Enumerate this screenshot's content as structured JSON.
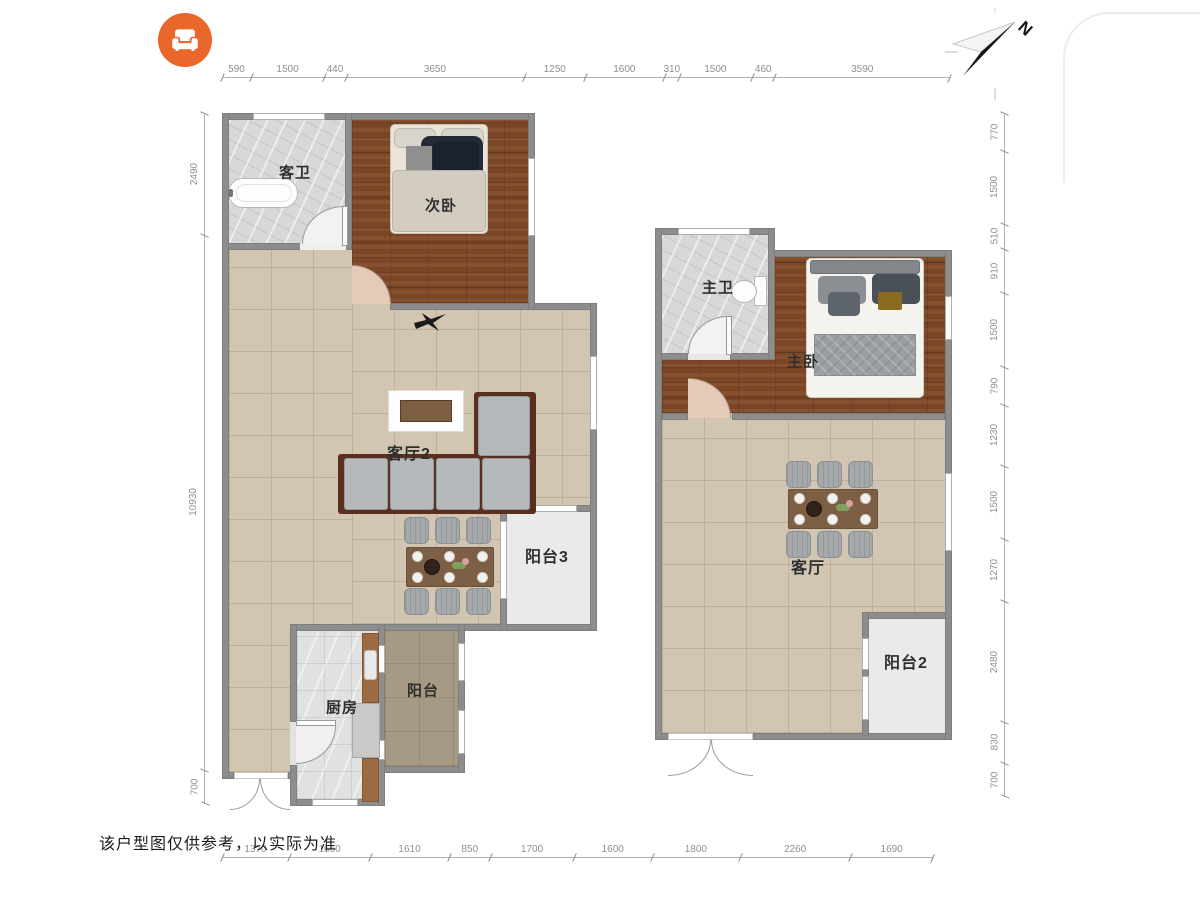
{
  "app": {
    "logo_icon": "sofa-icon"
  },
  "compass": {
    "label": "N"
  },
  "disclaimer": "该户型图仅供参考，以实际为准",
  "units": {
    "left": {
      "rooms": {
        "guest_bath": "客卫",
        "second_bedroom": "次卧",
        "living2": "客厅2",
        "balcony3": "阳台3",
        "kitchen": "厨房",
        "balcony": "阳台"
      }
    },
    "right": {
      "rooms": {
        "master_bath": "主卫",
        "master_bedroom": "主卧",
        "living": "客厅",
        "balcony2": "阳台2"
      }
    }
  },
  "dimensions_mm": {
    "top": [
      590,
      1500,
      440,
      3650,
      1250,
      1600,
      310,
      1500,
      460,
      3590
    ],
    "bottom": [
      1370,
      1660,
      1610,
      850,
      1700,
      1600,
      1800,
      2260,
      1690
    ],
    "left": [
      2490,
      10930,
      700
    ],
    "right": [
      770,
      1500,
      510,
      910,
      1500,
      790,
      1230,
      1500,
      1270,
      2480,
      830,
      700
    ]
  },
  "colors": {
    "accent_orange": "#ea672b",
    "wall_gray": "#8d8d8d",
    "wood_floor": "#7a4626",
    "tile_beige": "#d2c6b2",
    "tile_marble": "#d8d8d8",
    "balcony_taupe": "#a79a85",
    "balcony_light": "#eaeaea",
    "sofa_frame": "#5a2f1d",
    "cushion_gray": "#b6b9bb"
  }
}
